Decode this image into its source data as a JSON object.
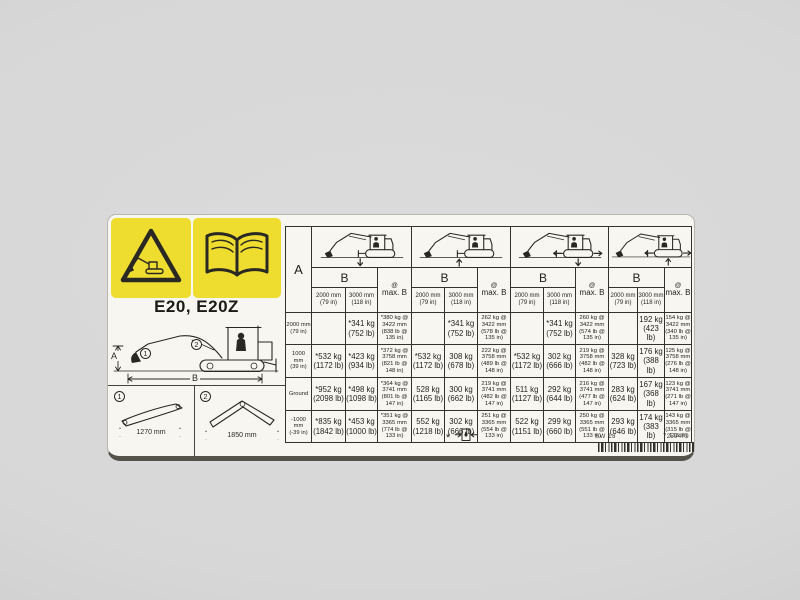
{
  "label": {
    "model": "E20, E20Z",
    "diagram": {
      "dim_a": "A",
      "dim_b": "B",
      "callout_1": "1",
      "callout_2": "2"
    },
    "options": [
      {
        "num": "1",
        "width": "1270 mm"
      },
      {
        "num": "2",
        "width": "1850 mm"
      }
    ],
    "footnote_star": "*",
    "footer": {
      "sw": "SW 18",
      "part": "7259479"
    },
    "icons": {
      "warning": "warning-triangle-excavator-icon",
      "manual": "read-operators-manual-book-icon",
      "footnote": "hydraulic-capacity-limit-icon",
      "load_cases": [
        "over-front-blade-down",
        "over-front-blade-up",
        "over-side-blade-down",
        "over-side-blade-up"
      ],
      "barcode": "barcode"
    },
    "colors": {
      "warning_yellow": "#eedc2f",
      "decal_bg": "#f7f6f1",
      "ink": "#2a2823"
    }
  },
  "table": {
    "corner": "A",
    "b_label": "B",
    "at_symbol": "@",
    "maxb_label": "max. B",
    "col_2000": "2000 mm\n(79 in)",
    "col_3000": "3000 mm\n(118 in)",
    "rows": [
      {
        "a": "2000 mm\n(79 in)",
        "c": [
          "",
          "*341 kg\n(752 lb)",
          "*380 kg @\n3422 mm\n(838 lb @\n135 in)",
          "",
          "*341 kg\n(752 lb)",
          "262 kg @\n3422 mm\n(578 lb @\n135 in)",
          "",
          "*341 kg\n(752 lb)",
          "260 kg @\n3422 mm\n(574 lb @\n135 in)",
          "",
          "192 kg\n(423 lb)",
          "154 kg @\n3422 mm\n(340 lb @\n135 in)"
        ]
      },
      {
        "a": "1000\nmm\n(39 in)",
        "c": [
          "*532 kg\n(1172 lb)",
          "*423 kg\n(934 lb)",
          "*372 kg @\n3758 mm\n(821 lb @\n148 in)",
          "*532 kg\n(1172 lb)",
          "308 kg\n(678 lb)",
          "222 kg @\n3758 mm\n(489 lb @\n148 in)",
          "*532 kg\n(1172 lb)",
          "302 kg\n(666 lb)",
          "219 kg @\n3758 mm\n(482 lb @\n148 in)",
          "328 kg\n(723 lb)",
          "176 kg\n(388 lb)",
          "125 kg @\n3758 mm\n(276 lb @\n148 in)"
        ]
      },
      {
        "a": "Ground",
        "c": [
          "*952 kg\n(2098 lb)",
          "*498 kg\n(1098 lb)",
          "*364 kg @\n3741 mm\n(801 lb @\n147 in)",
          "528 kg\n(1165 lb)",
          "300 kg\n(662 lb)",
          "219 kg @\n3741 mm\n(482 lb @\n147 in)",
          "511 kg\n(1127 lb)",
          "292 kg\n(644 lb)",
          "216 kg @\n3741 mm\n(477 lb @\n147 in)",
          "283 kg\n(624 lb)",
          "167 kg\n(368 lb)",
          "123 kg @\n3741 mm\n(271 lb @\n147 in)"
        ]
      },
      {
        "a": "-1000\nmm\n(-39 in)",
        "c": [
          "*835 kg\n(1842 lb)",
          "*453 kg\n(1000 lb)",
          "*351 kg @\n3365 mm\n(774 lb @\n133 in)",
          "552 kg\n(1218 lb)",
          "302 kg\n(666 lb)",
          "251 kg @\n3365 mm\n(554 lb @\n133 in)",
          "522 kg\n(1151 lb)",
          "299 kg\n(660 lb)",
          "250 kg @\n3365 mm\n(551 lb @\n133 in)",
          "293 kg\n(646 lb)",
          "174 kg\n(383 lb)",
          "143 kg @\n3365 mm\n(315 lb @\n133 in)"
        ]
      }
    ]
  }
}
